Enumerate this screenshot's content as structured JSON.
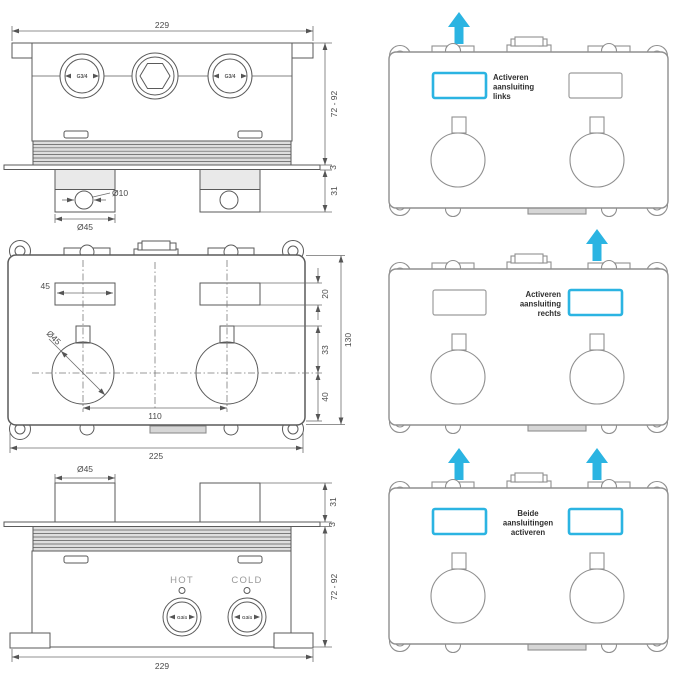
{
  "colors": {
    "accent_blue": "#2bb4e2"
  },
  "drawings": {
    "top_view": {
      "dim_width": "229",
      "dim_depth_range": "72 - 92",
      "dim_plate_thickness": "3",
      "dim_connector_depth": "31",
      "dim_hole_diameter": "Ø10",
      "dim_connector_diameter": "Ø45",
      "port_left": "G3/4",
      "port_right": "G3/4"
    },
    "front_view": {
      "dim_slot_width": "45",
      "dim_slot_height": "20",
      "dim_stem_to_center": "33",
      "dim_center_to_bottom": "40",
      "dim_total_height": "130",
      "dim_port_spacing": "110",
      "dim_total_width": "225",
      "dim_knob_diameter": "Ø45"
    },
    "bottom_view": {
      "dim_connector_diameter": "Ø45",
      "dim_connector_depth": "31",
      "dim_plate_thickness": "3",
      "dim_depth_range": "72 - 92",
      "dim_width": "229",
      "label_hot": "HOT",
      "label_cold": "COLD",
      "port_hot": "G3/4",
      "port_cold": "G3/4"
    },
    "options": {
      "left": {
        "line1": "Activeren",
        "line2": "aansluiting",
        "line3": "links"
      },
      "right": {
        "line1": "Activeren",
        "line2": "aansluiting",
        "line3": "rechts"
      },
      "both": {
        "line1": "Beide",
        "line2": "aansluitingen",
        "line3": "activeren"
      }
    }
  }
}
